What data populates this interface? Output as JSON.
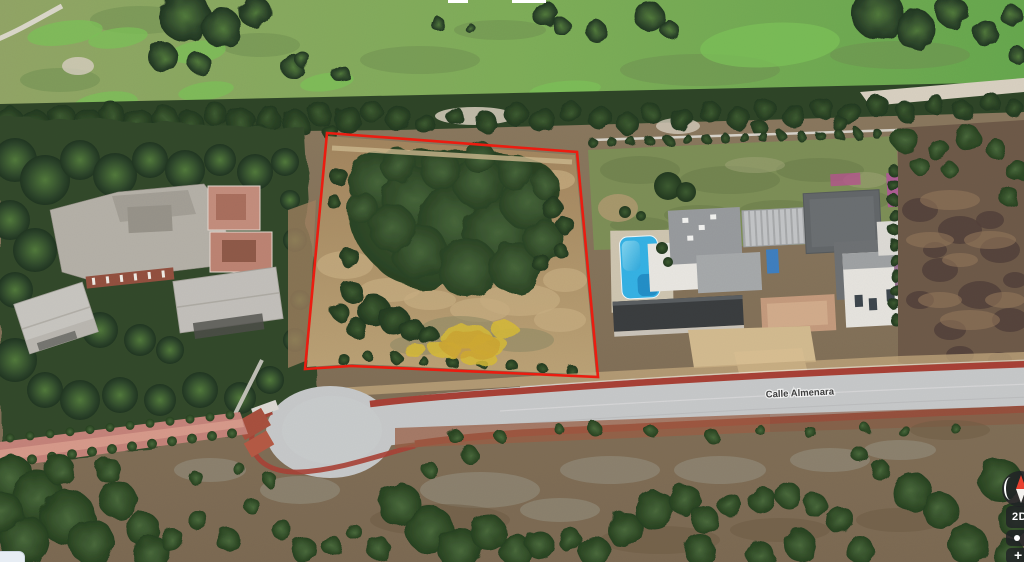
{
  "street": {
    "name": "Calle Almenara"
  },
  "controls": {
    "view_toggle": "2D",
    "zoom_in": "+",
    "compass_icon": "compass-north-needle",
    "my_location_icon": "my-location-dot"
  },
  "overlay": {
    "plot_outline_color": "#ee1c10"
  },
  "scene": {
    "pool_color": "#35b2e5",
    "road_color": "#c7c9ca",
    "bike_lane_color": "#a84136",
    "golf_color": "#7fae59"
  }
}
